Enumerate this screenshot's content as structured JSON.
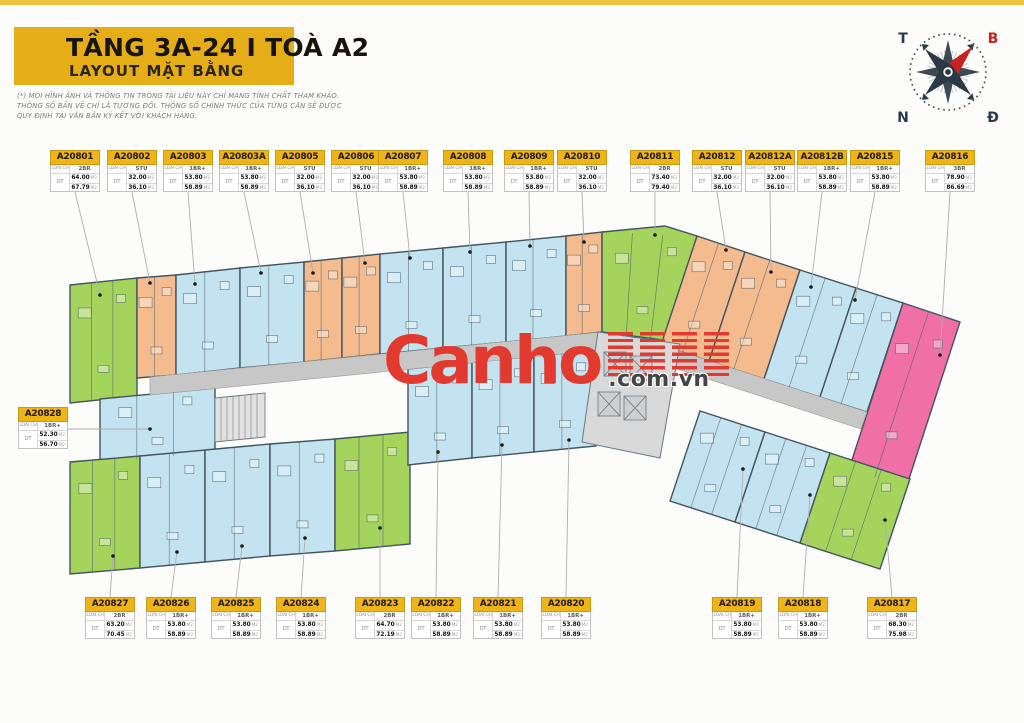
{
  "header": {
    "title": "TẦNG 3A-24 I TOÀ A2",
    "subtitle": "LAYOUT MẶT BẰNG",
    "bg_color": "#e5ad18"
  },
  "disclaimer": {
    "line1": "(*) MỌI HÌNH ẢNH VÀ THÔNG TIN TRONG TÀI LIỆU NÀY CHỈ MANG TÍNH CHẤT THAM KHẢO.",
    "line2": "THÔNG SỐ BẢN VẼ CHỈ LÀ TƯƠNG ĐỐI. THÔNG SỐ CHÍNH THỨC CỦA TỪNG CĂN SẼ ĐƯỢC",
    "line3": "QUY ĐỊNH TẠI VĂN BẢN KÝ KẾT VỚI KHÁCH HÀNG."
  },
  "compass": {
    "west": "T",
    "north": "B",
    "south": "N",
    "east": "Đ",
    "needle_color": "#c5231f"
  },
  "watermark": {
    "brand": "Canho",
    "suffix": ".com.vn",
    "color": "#e23a2e"
  },
  "strings": {
    "type_label": "LOẠI CH",
    "area_label": "DT",
    "area_unit": "M2"
  },
  "palette": {
    "STU": "#f3bb8e",
    "1BR+": "#c4e3f0",
    "2BR": "#a5d45c",
    "3BR": "#f06fa6",
    "corridor": "#c7c7c7",
    "core": "#d9d9d9",
    "wall": "#44535d",
    "label_yellow": "#efb417"
  },
  "units": [
    {
      "id": "A20801",
      "type": "2BR",
      "area1": "64.00",
      "area2": "67.79",
      "row": "top"
    },
    {
      "id": "A20802",
      "type": "STU",
      "area1": "32.00",
      "area2": "36.10",
      "row": "top"
    },
    {
      "id": "A20803",
      "type": "1BR+",
      "area1": "53.80",
      "area2": "58.89",
      "row": "top"
    },
    {
      "id": "A20803A",
      "type": "1BR+",
      "area1": "53.80",
      "area2": "58.89",
      "row": "top"
    },
    {
      "id": "A20805",
      "type": "STU",
      "area1": "32.00",
      "area2": "36.10",
      "row": "top"
    },
    {
      "id": "A20806",
      "type": "STU",
      "area1": "32.00",
      "area2": "36.10",
      "row": "top"
    },
    {
      "id": "A20807",
      "type": "1BR+",
      "area1": "53.80",
      "area2": "58.89",
      "row": "top"
    },
    {
      "id": "A20808",
      "type": "1BR+",
      "area1": "53.80",
      "area2": "58.89",
      "row": "top"
    },
    {
      "id": "A20809",
      "type": "1BR+",
      "area1": "53.80",
      "area2": "58.89",
      "row": "top"
    },
    {
      "id": "A20810",
      "type": "STU",
      "area1": "32.00",
      "area2": "36.10",
      "row": "top"
    },
    {
      "id": "A20811",
      "type": "2BR",
      "area1": "73.40",
      "area2": "79.40",
      "row": "top"
    },
    {
      "id": "A20812",
      "type": "STU",
      "area1": "32.00",
      "area2": "36.10",
      "row": "top"
    },
    {
      "id": "A20812A",
      "type": "STU",
      "area1": "32.00",
      "area2": "36.10",
      "row": "top"
    },
    {
      "id": "A20812B",
      "type": "1BR+",
      "area1": "53.80",
      "area2": "58.89",
      "row": "top"
    },
    {
      "id": "A20815",
      "type": "1BR+",
      "area1": "53.80",
      "area2": "58.89",
      "row": "top"
    },
    {
      "id": "A20816",
      "type": "3BR",
      "area1": "78.90",
      "area2": "86.69",
      "row": "top"
    },
    {
      "id": "A20828",
      "type": "1BR+",
      "area1": "52.30",
      "area2": "56.70",
      "row": "left"
    },
    {
      "id": "A20827",
      "type": "2BR",
      "area1": "63.20",
      "area2": "70.45",
      "row": "bottom"
    },
    {
      "id": "A20826",
      "type": "1BR+",
      "area1": "53.80",
      "area2": "58.89",
      "row": "bottom"
    },
    {
      "id": "A20825",
      "type": "1BR+",
      "area1": "53.80",
      "area2": "58.89",
      "row": "bottom"
    },
    {
      "id": "A20824",
      "type": "1BR+",
      "area1": "53.80",
      "area2": "58.89",
      "row": "bottom"
    },
    {
      "id": "A20823",
      "type": "2BR",
      "area1": "64.70",
      "area2": "72.19",
      "row": "bottom"
    },
    {
      "id": "A20822",
      "type": "1BR+",
      "area1": "53.80",
      "area2": "58.89",
      "row": "bottom"
    },
    {
      "id": "A20821",
      "type": "1BR+",
      "area1": "53.80",
      "area2": "58.89",
      "row": "bottom"
    },
    {
      "id": "A20820",
      "type": "1BR+",
      "area1": "53.80",
      "area2": "58.89",
      "row": "bottom"
    },
    {
      "id": "A20819",
      "type": "1BR+",
      "area1": "53.80",
      "area2": "58.89",
      "row": "bottom"
    },
    {
      "id": "A20818",
      "type": "1BR+",
      "area1": "53.80",
      "area2": "58.89",
      "row": "bottom"
    },
    {
      "id": "A20817",
      "type": "2BR",
      "area1": "68.30",
      "area2": "75.98",
      "row": "bottom"
    }
  ]
}
